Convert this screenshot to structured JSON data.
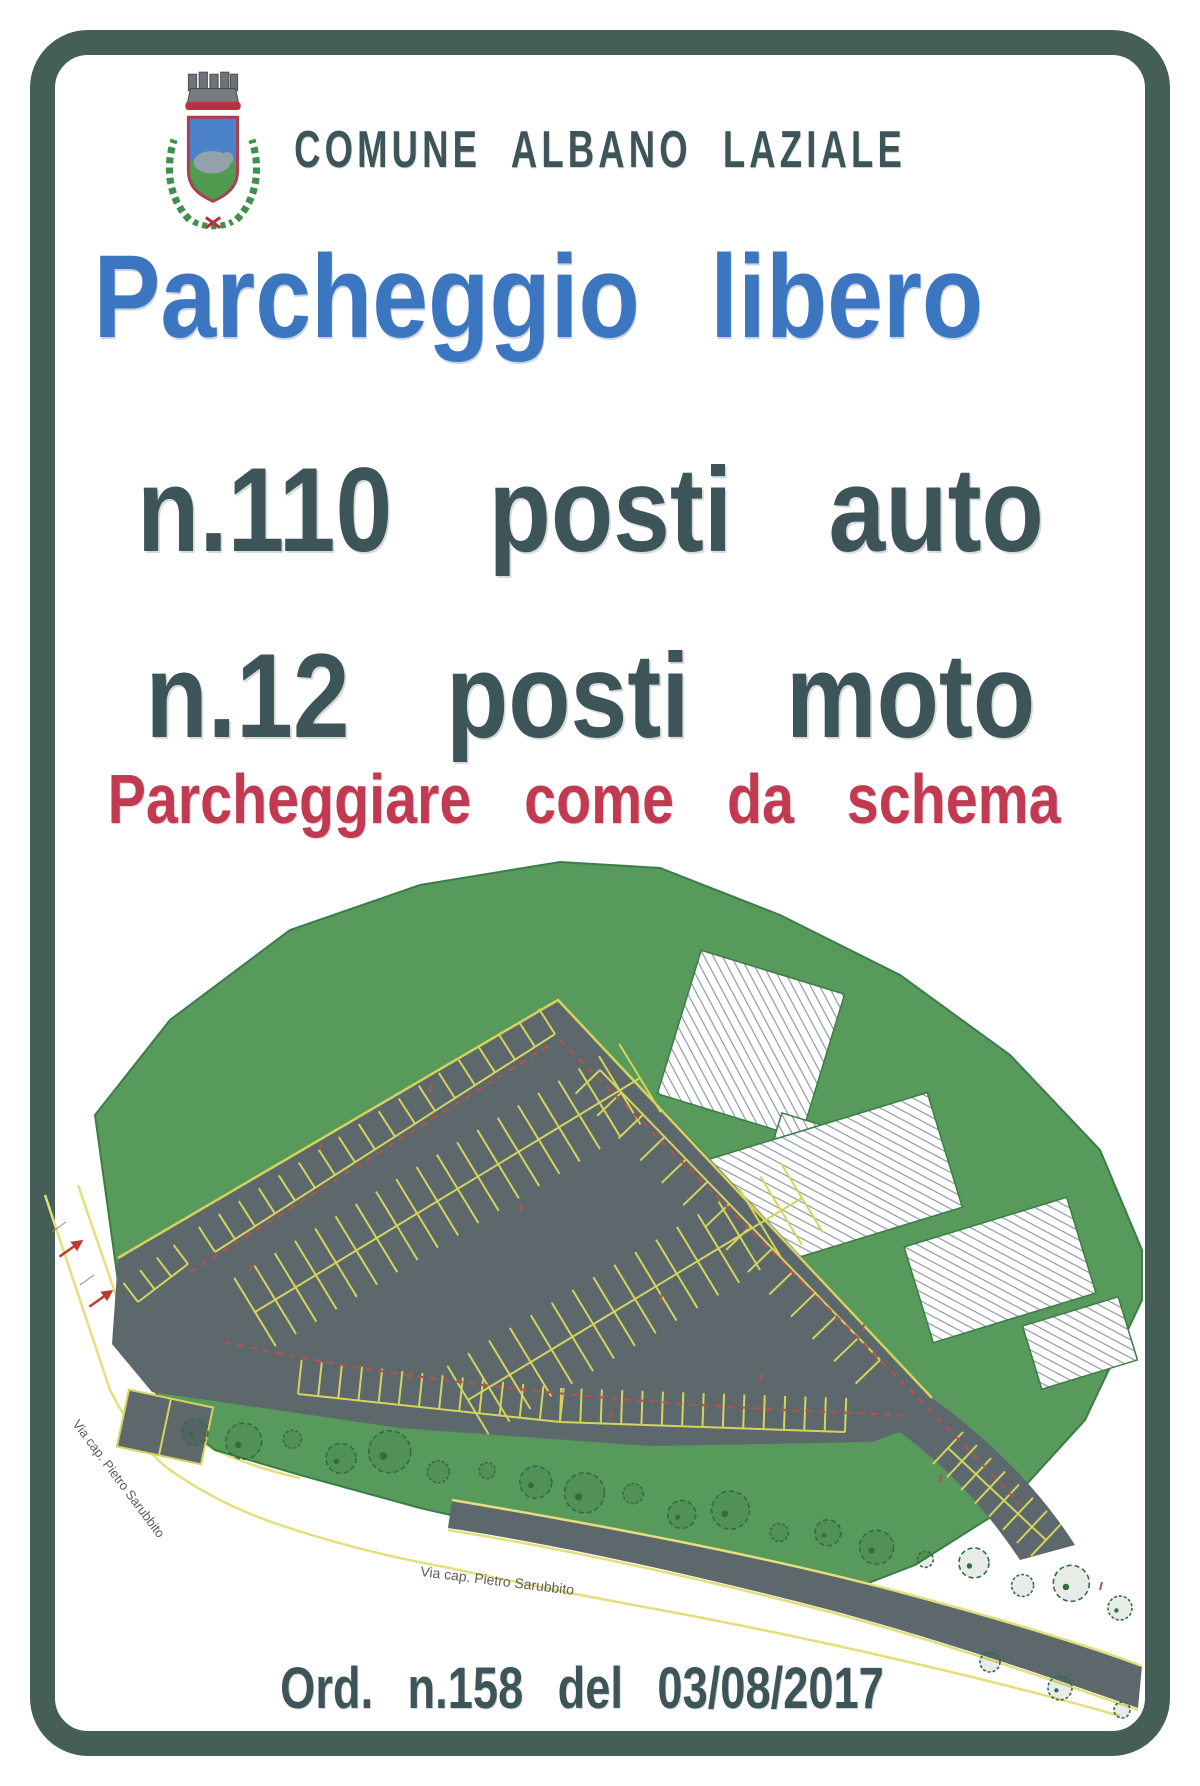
{
  "header": {
    "municipality": "COMUNE ALBANO LAZIALE"
  },
  "headline": {
    "title": "Parcheggio libero",
    "car_line": "n.110 posti auto",
    "moto_line": "n.12 posti moto",
    "instruction": "Parcheggiare come da schema"
  },
  "footer": {
    "ordinance": "Ord. n.158 del 03/08/2017"
  },
  "map": {
    "street_label_left": "Via cap. Pietro Sarubbito",
    "street_label_bottom": "Via cap. Pietro Sarubbito"
  },
  "colors": {
    "frame_green": "#455f58",
    "text_dark": "#3d5458",
    "title_blue": "#3c76c1",
    "alert_red": "#c23a52",
    "site_green": "#58995c",
    "site_edge": "#3a7d47",
    "asphalt_gray": "#5c686c",
    "stall_yellow": "#d4d45c",
    "road_yellow": "#e3df7a",
    "dashed_red": "#b0544e",
    "tree_green": "#2f6e3c",
    "hatch_gray": "#939aa0",
    "label_gray": "#5d5d58",
    "crest_red": "#b73140",
    "crest_blue": "#4b82c9",
    "crest_green": "#4f9c51"
  }
}
